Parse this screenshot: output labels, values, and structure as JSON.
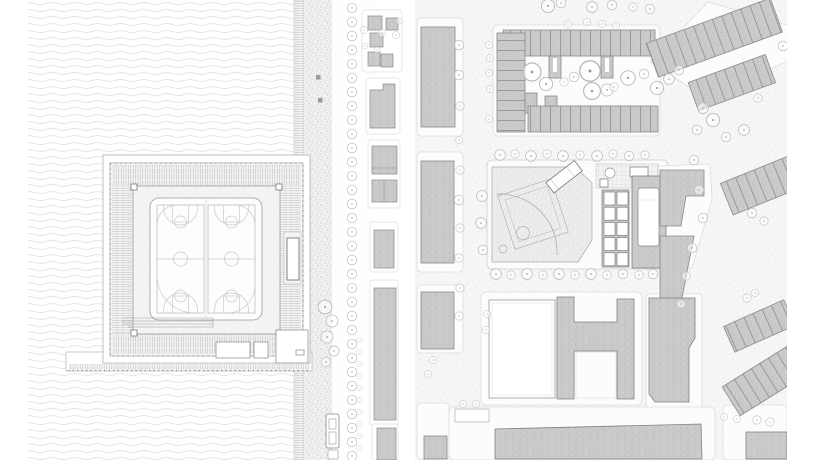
{
  "figure": {
    "description": "Two monochrome architectural site plans side by side. Left: a waterfront sports hall with two basketball courts set on a pier platform, surrounded by stepped ramp bands, beside a seawall, planted promenade, tree-lined street and a strip of city parcels. Right: the urban context plan with a perimeter housing block around a tree-filled courtyard, diagonal rowhouse strips, a park block containing a baseball field, play courts and a pool hall, an H-shaped building, and large hatched city blocks along stippled streets.",
    "panel_count": 2
  },
  "panels": {
    "left": {
      "name": "waterfront-site-plan",
      "features": [
        "water",
        "seawall",
        "promenade",
        "street-tree-row",
        "sports-hall",
        "basketball-courts",
        "ramp-bands",
        "pier",
        "city-parcels",
        "tram-stop"
      ],
      "basketball_court_count": 2
    },
    "right": {
      "name": "urban-context-plan",
      "features": [
        "street-grid",
        "perimeter-housing-block",
        "courtyard-trees",
        "rowhouse-strips",
        "baseball-field",
        "play-courts",
        "pool-building",
        "h-shaped-building",
        "city-blocks",
        "street-trees"
      ],
      "play_court_count": 10,
      "pool_count": 1,
      "baseball_field_count": 1
    }
  },
  "colors": {
    "paper": "#ffffff",
    "water_line": "#e2e2e2",
    "street": "#f6f6f6",
    "building": "#cacaca",
    "building_outline": "#8a8a8a",
    "tree": "#b9b9b9",
    "court_line": "#c9c9c9",
    "detail_line": "#9a9a9a"
  }
}
